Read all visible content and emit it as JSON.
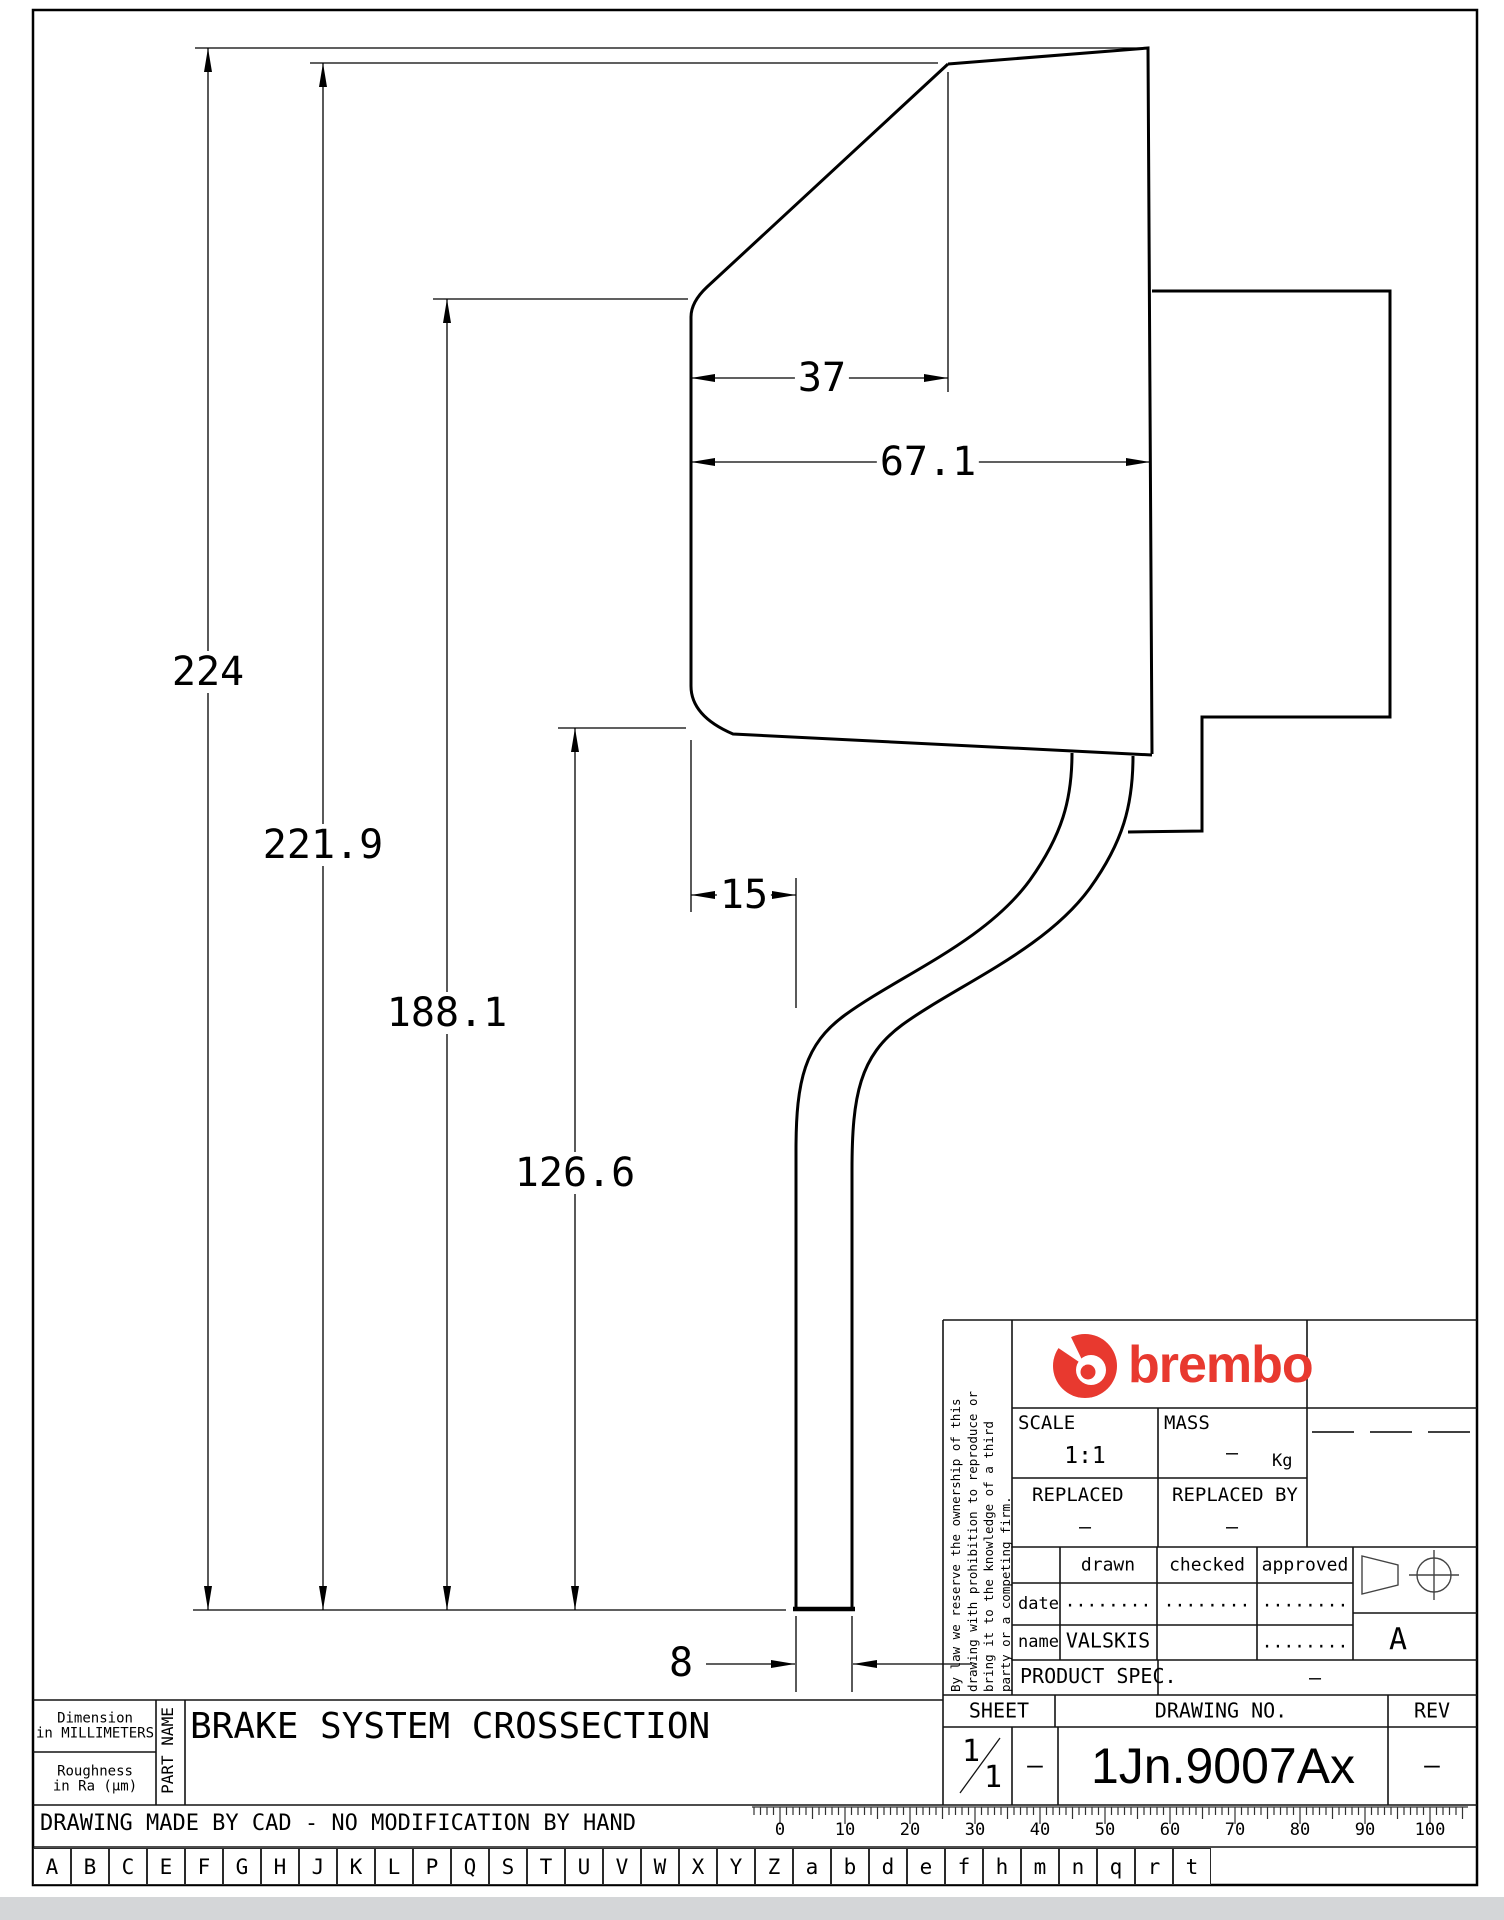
{
  "drawing": {
    "title": "BRAKE SYSTEM CROSSECTION",
    "dimensions": {
      "total_height": "224",
      "second_height": "221.9",
      "hat_top_height": "188.1",
      "flange_height": "126.6",
      "top_width": "37",
      "hat_width": "67.1",
      "arm_offset": "15",
      "arm_width": "8"
    }
  },
  "title_block": {
    "disclaimer_l1": "By law we reserve the ownership of this",
    "disclaimer_l2": "drawing with prohibition to reproduce or",
    "disclaimer_l3": "bring it to the knowledge of a third",
    "disclaimer_l4": "party or a competing firm.",
    "brand_wordmark": "brembo",
    "scale_label": "SCALE",
    "scale_value": "1:1",
    "mass_label": "MASS",
    "mass_value": "–",
    "mass_unit": "Kg",
    "replaced_label": "REPLACED",
    "replaced_value": "–",
    "replaced_by_label": "REPLACED BY",
    "replaced_by_value": "–",
    "col_drawn": "drawn",
    "col_checked": "checked",
    "col_approved": "approved",
    "row_date_label": "date",
    "date_drawn": "........",
    "date_checked": "........",
    "date_approved": "........",
    "row_name_label": "name",
    "name_drawn": "VALSKIS",
    "name_approved": "........",
    "product_spec_label": "PRODUCT SPEC.",
    "product_spec_value": "–",
    "sheet_label": "SHEET",
    "sheet_num": "1",
    "sheet_den": "1",
    "sheet_dash": "–",
    "drawing_no_label": "DRAWING NO.",
    "drawing_no": "1Jn.9007Ax",
    "rev_label": "REV",
    "rev_value": "–",
    "projection_letter": "A"
  },
  "footer": {
    "dimension_note_l1": "Dimension",
    "dimension_note_l2": "in MILLIMETERS",
    "roughness_note_l1": "Roughness",
    "roughness_note_l2": "in Ra (μm)",
    "part_name_label": "PART NAME",
    "cad_note": "DRAWING MADE BY CAD - NO MODIFICATION BY HAND",
    "letters": [
      "A",
      "B",
      "C",
      "E",
      "F",
      "G",
      "H",
      "J",
      "K",
      "L",
      "P",
      "Q",
      "S",
      "T",
      "U",
      "V",
      "W",
      "X",
      "Y",
      "Z",
      "a",
      "b",
      "d",
      "e",
      "f",
      "h",
      "m",
      "n",
      "q",
      "r",
      "t"
    ],
    "ruler_labels": [
      "0",
      "10",
      "20",
      "30",
      "40",
      "50",
      "60",
      "70",
      "80",
      "90",
      "100"
    ]
  },
  "colors": {
    "brand_red": "#e8392f",
    "line": "#000000"
  }
}
